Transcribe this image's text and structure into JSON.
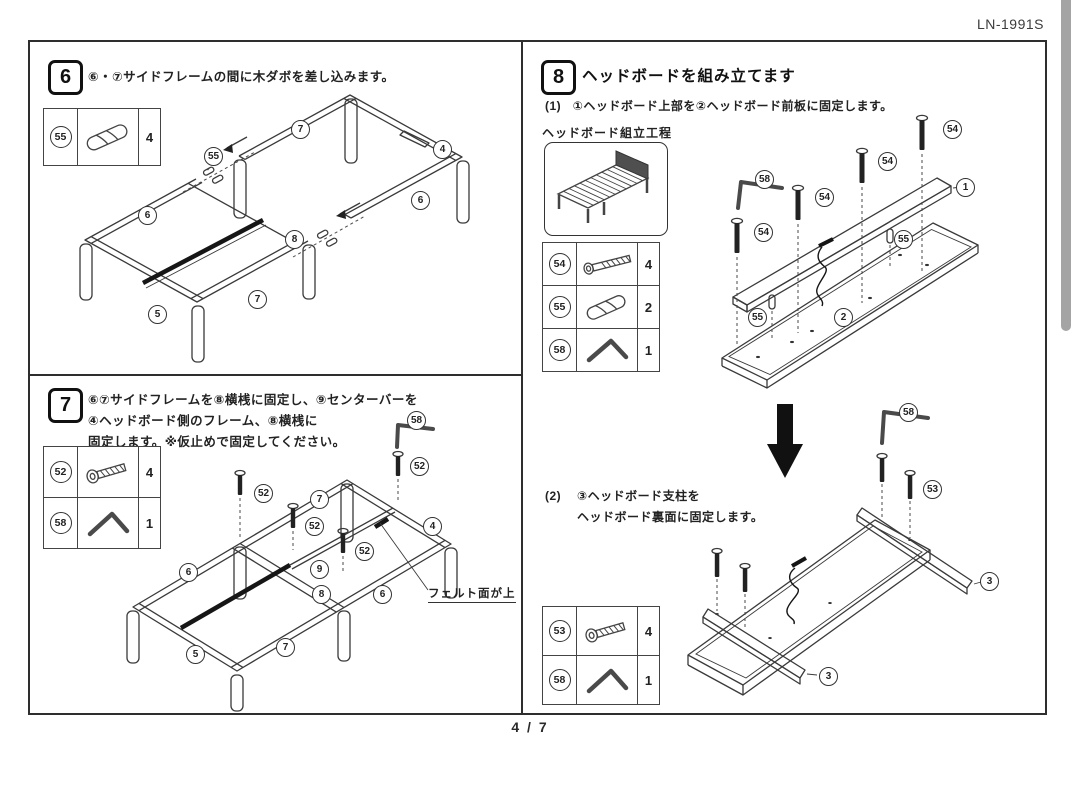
{
  "page": {
    "doc_code": "LN-1991S",
    "page_indicator": "4 / 7"
  },
  "colors": {
    "line": "#3a3a3a",
    "scrollbar": "#a4a4a4",
    "headboard_fill": "#4f4f4f"
  },
  "step6": {
    "number": "6",
    "instruction": "⑥・⑦サイドフレームの間に木ダボを差し込みます。",
    "parts": [
      {
        "id": "55",
        "icon": "wood-dowel",
        "qty": "4"
      }
    ],
    "diagram_labels": [
      "7",
      "4",
      "55",
      "6",
      "6",
      "8",
      "5",
      "7"
    ]
  },
  "step7": {
    "number": "7",
    "instruction_lines": [
      "⑥⑦サイドフレームを⑧横桟に固定し、⑨センターバーを",
      "④ヘッドボード側のフレーム、⑧横桟に",
      "固定します。※仮止めで固定してください。"
    ],
    "parts": [
      {
        "id": "52",
        "icon": "bolt",
        "qty": "4"
      },
      {
        "id": "58",
        "icon": "hex-key",
        "qty": "1"
      }
    ],
    "diagram_labels": [
      "58",
      "52",
      "52",
      "52",
      "52",
      "7",
      "4",
      "6",
      "9",
      "8",
      "6",
      "5",
      "7"
    ],
    "callout": "フェルト面が上"
  },
  "step8": {
    "number": "8",
    "title": "ヘッドボードを組み立てます",
    "sub1_label": "(1)",
    "sub1_text": "①ヘッドボード上部を②ヘッドボード前板に固定します。",
    "process_title": "ヘッドボード組立工程",
    "parts1": [
      {
        "id": "54",
        "icon": "bolt-long",
        "qty": "4"
      },
      {
        "id": "55",
        "icon": "wood-dowel",
        "qty": "2"
      },
      {
        "id": "58",
        "icon": "hex-key",
        "qty": "1"
      }
    ],
    "diagram1_labels": [
      "58",
      "54",
      "54",
      "54",
      "54",
      "1",
      "55",
      "55",
      "2"
    ],
    "sub2_label": "(2)",
    "sub2_lines": [
      "③ヘッドボード支柱を",
      "ヘッドボード裏面に固定します。"
    ],
    "parts2": [
      {
        "id": "53",
        "icon": "bolt",
        "qty": "4"
      },
      {
        "id": "58",
        "icon": "hex-key",
        "qty": "1"
      }
    ],
    "diagram2_labels": [
      "58",
      "53",
      "3",
      "3"
    ]
  }
}
